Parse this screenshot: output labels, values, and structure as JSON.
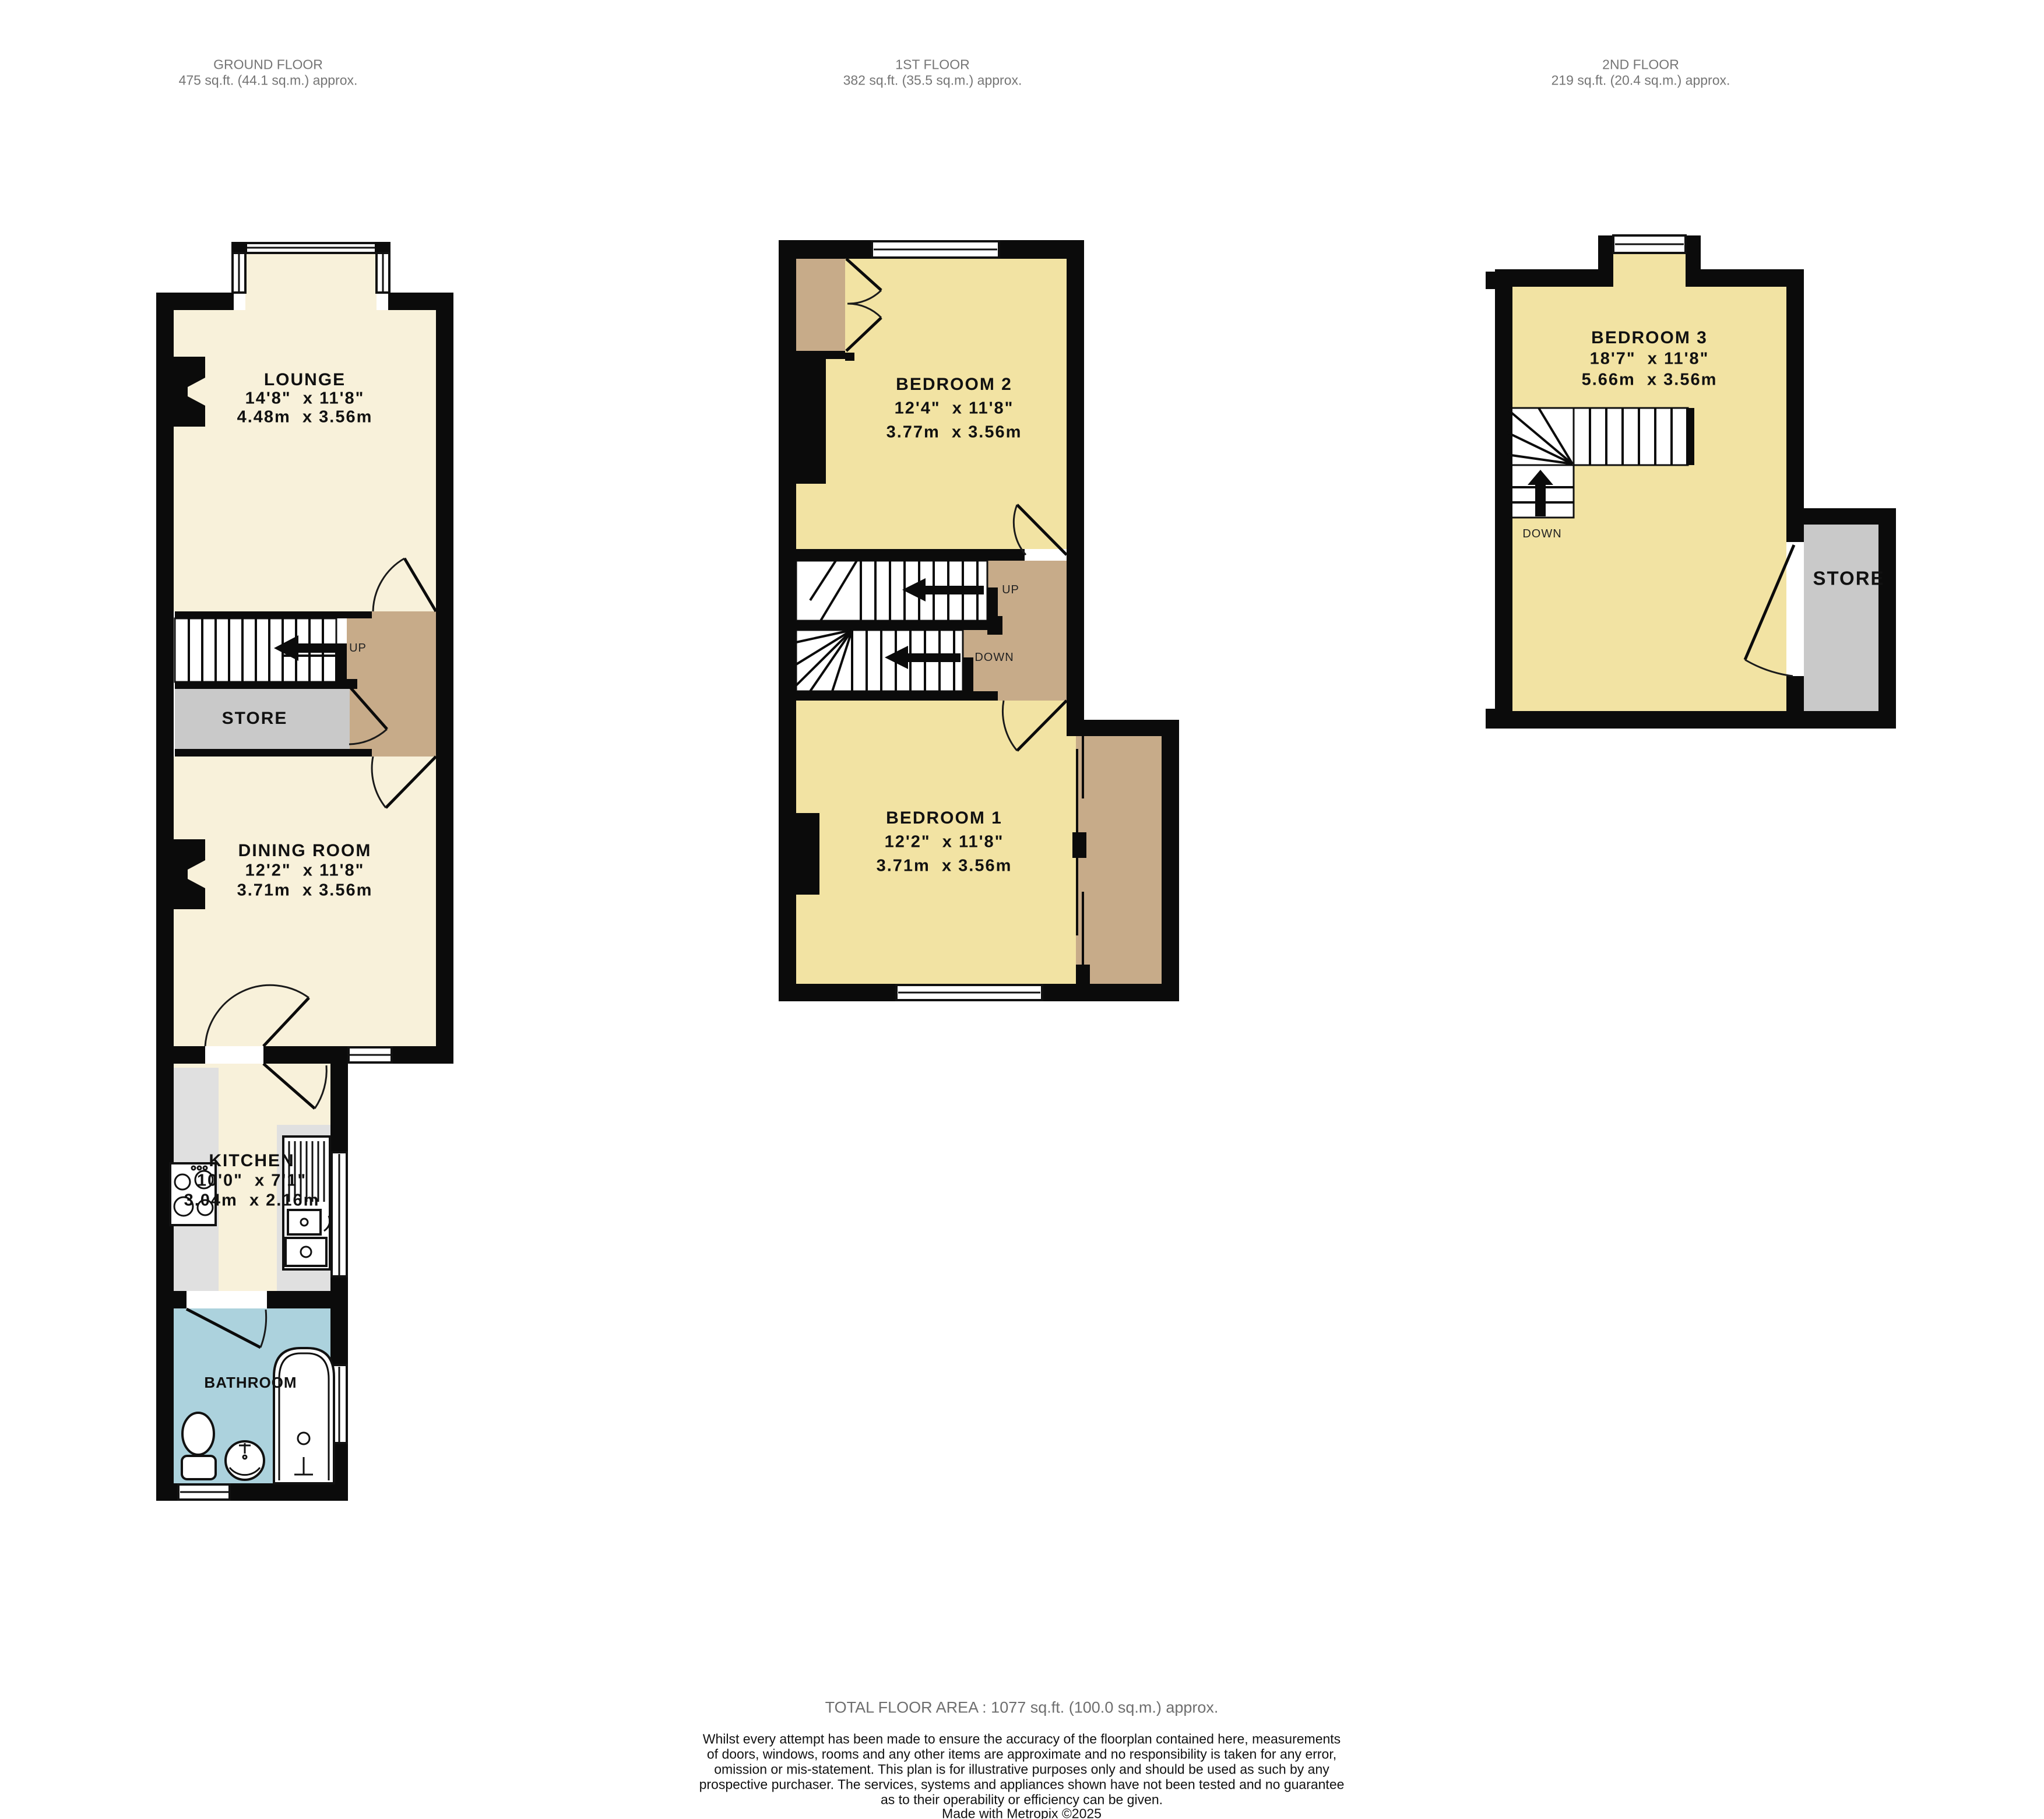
{
  "floors": [
    {
      "title": "GROUND FLOOR",
      "area": "475 sq.ft. (44.1 sq.m.) approx."
    },
    {
      "title": "1ST FLOOR",
      "area": "382 sq.ft. (35.5 sq.m.) approx."
    },
    {
      "title": "2ND FLOOR",
      "area": "219 sq.ft. (20.4 sq.m.) approx."
    }
  ],
  "rooms": {
    "lounge": {
      "name": "LOUNGE",
      "imperial": "14'8\"  x 11'8\"",
      "metric": "4.48m  x 3.56m"
    },
    "dining_room": {
      "name": "DINING ROOM",
      "imperial": "12'2\"  x 11'8\"",
      "metric": "3.71m  x 3.56m"
    },
    "kitchen": {
      "name": "KITCHEN",
      "imperial": "10'0\"  x 7'1\"",
      "metric": "3.04m  x 2.16m"
    },
    "bathroom": {
      "name": "BATHROOM"
    },
    "store_ground": {
      "name": "STORE"
    },
    "bedroom2": {
      "name": "BEDROOM 2",
      "imperial": "12'4\"  x 11'8\"",
      "metric": "3.77m  x 3.56m"
    },
    "bedroom1": {
      "name": "BEDROOM 1",
      "imperial": "12'2\"  x 11'8\"",
      "metric": "3.71m  x 3.56m"
    },
    "bedroom3": {
      "name": "BEDROOM 3",
      "imperial": "18'7\"  x 11'8\"",
      "metric": "5.66m  x 3.56m"
    },
    "store_second": {
      "name": "STORE"
    }
  },
  "stairs": {
    "up": "UP",
    "down": "DOWN"
  },
  "footer": {
    "total": "TOTAL FLOOR AREA : 1077 sq.ft. (100.0 sq.m.) approx.",
    "disclaimer_lines": [
      "Whilst every attempt has been made to ensure the accuracy of the floorplan contained here, measurements",
      "of doors, windows, rooms and any other items are approximate and no responsibility is taken for any error,",
      "omission or mis-statement. This plan is for illustrative purposes only and should be used as such by any",
      "prospective purchaser. The services, systems and appliances shown have not been tested and no guarantee",
      "as to their operability or efficiency can be given."
    ],
    "credit": "Made with Metropix ©2025"
  },
  "colors": {
    "wall": "#0b0b0b",
    "ground_room_fill": "#f8f1da",
    "bedroom_fill": "#f2e3a3",
    "landing_fill": "#c7ab89",
    "store_fill": "#c9c9c9",
    "counter_fill": "#e0e0e0",
    "bathroom_fill": "#acd2dd",
    "header_text": "#757575",
    "footer_total_text": "#6e6e6e"
  }
}
